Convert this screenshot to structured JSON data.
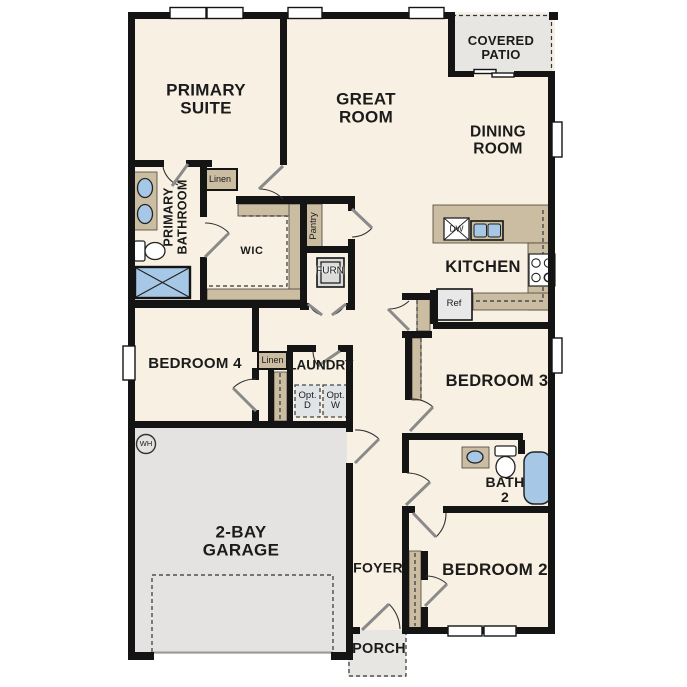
{
  "plan_title": "Single-story 4 bedroom floor plan",
  "colors": {
    "floor": "#f8f0e2",
    "wall": "#141414",
    "cabinet_tan": "#cbbda2",
    "garage_gray": "#e4e3e1",
    "patio_gray": "#e7e6e3",
    "fixture_blue": "#a7c7e7",
    "option_box_gray": "#e0e4e7",
    "appliance_gray": "#e8e8e8"
  },
  "labels": {
    "primary_suite": "PRIMARY\nSUITE",
    "great_room": "GREAT\nROOM",
    "dining_room": "DINING\nROOM",
    "covered_patio": "COVERED\nPATIO",
    "primary_bathroom": "PRIMARY\nBATHROOM",
    "linen_primary": "Linen",
    "wic": "WIC",
    "pantry": "Pantry",
    "furnace": "FURN",
    "kitchen": "KITCHEN",
    "dishwasher": "DW",
    "refrigerator": "Ref",
    "bedroom_4": "BEDROOM 4",
    "linen_hall": "Linen",
    "laundry": "LAUNDRY",
    "opt_dryer": "Opt.\nD",
    "opt_washer": "Opt.\nW",
    "bedroom_3": "BEDROOM 3",
    "water_heater": "WH",
    "bath_2": "BATH\n2",
    "garage": "2-BAY\nGARAGE",
    "foyer": "FOYER",
    "bedroom_2": "BEDROOM 2",
    "porch": "PORCH"
  }
}
